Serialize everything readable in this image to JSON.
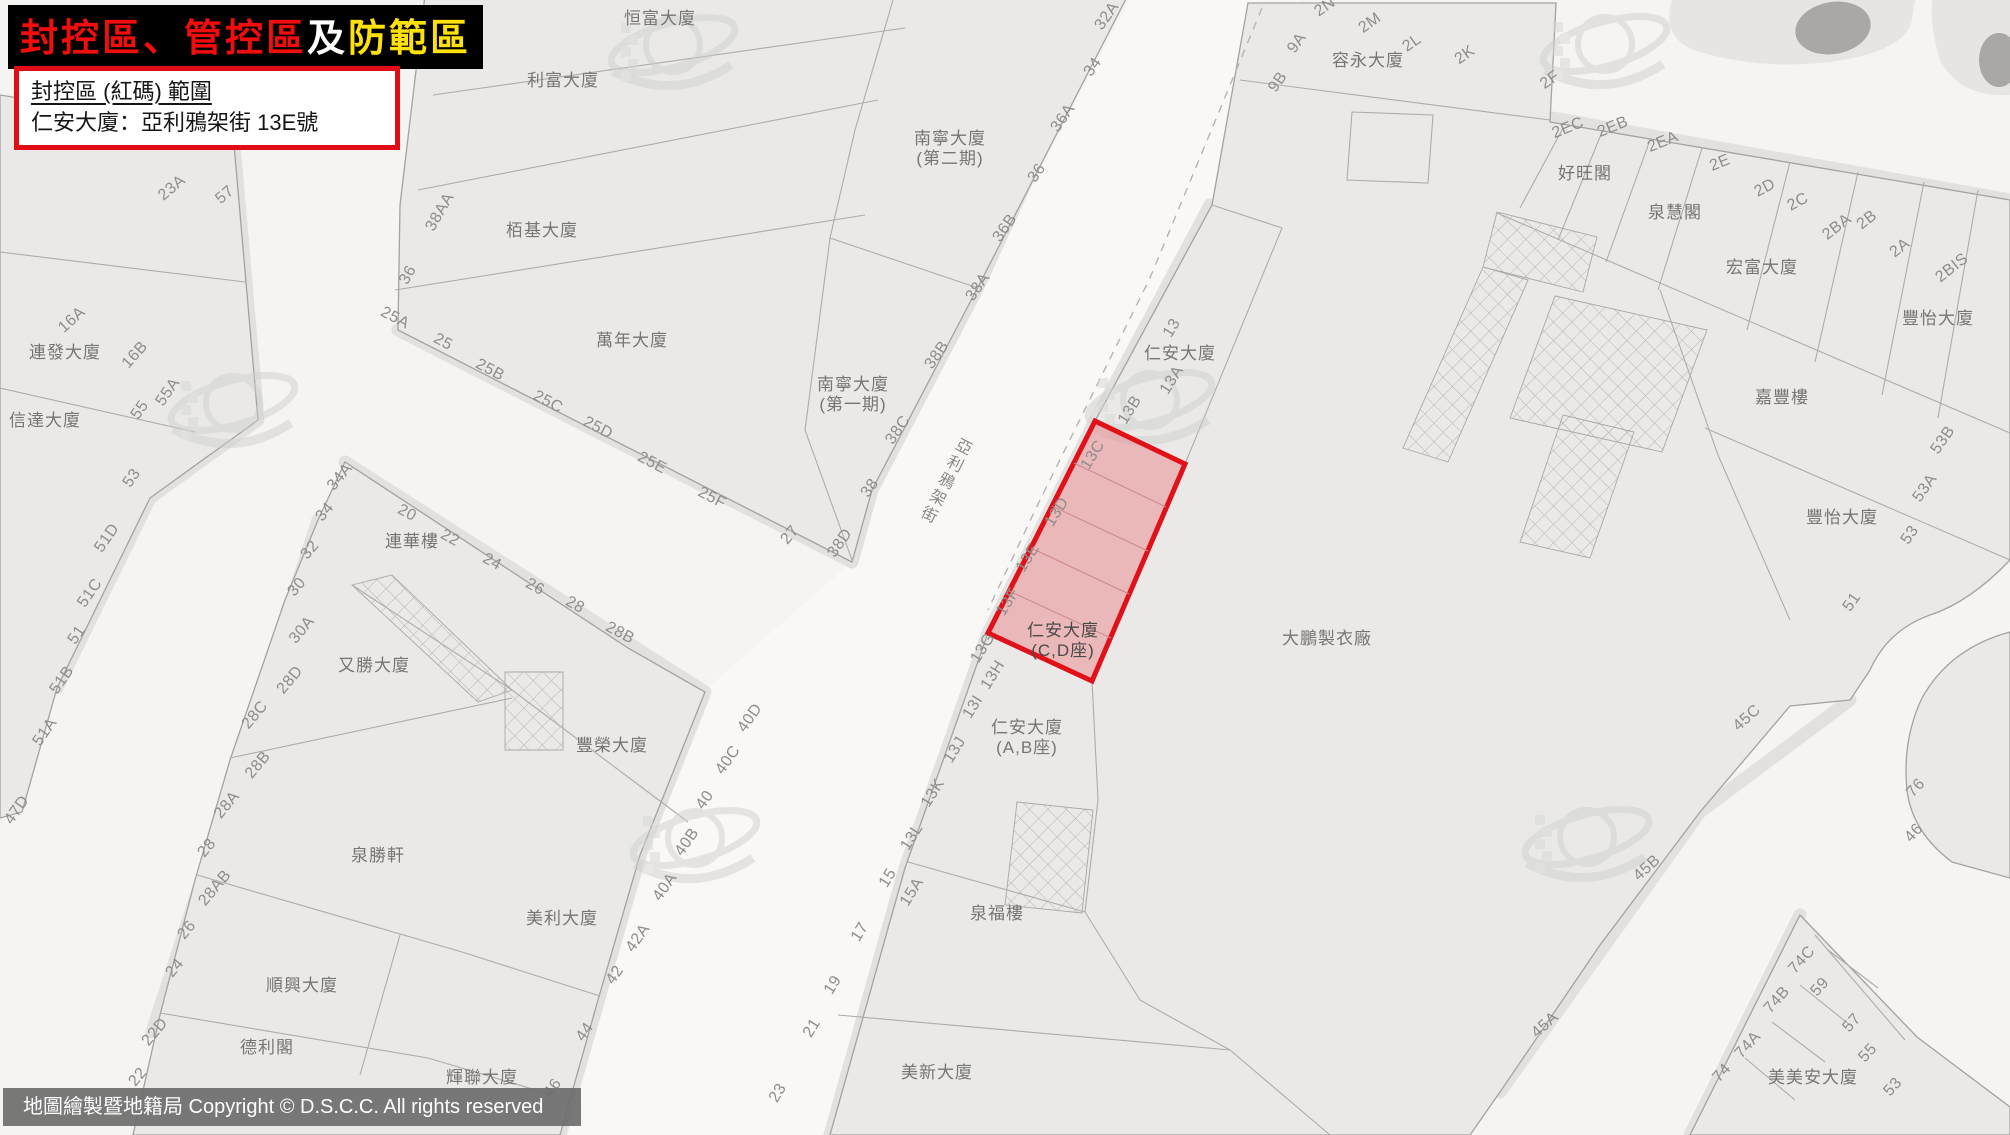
{
  "banner": {
    "segments": [
      {
        "text": "封控區、管控區",
        "color": "#f20d0d"
      },
      {
        "text": "及",
        "color": "#ffffff"
      },
      {
        "text": "防範區",
        "color": "#ffe10a"
      }
    ]
  },
  "info_box": {
    "line1": "封控區 (紅碼) 範圍",
    "line2": "仁安大廈：亞利鴉架街 13E號",
    "border_color": "#e20d14"
  },
  "footer": {
    "text": "地圖繪製暨地籍局 Copyright © D.S.C.C. All rights reserved"
  },
  "map": {
    "street_name": "亞利鴉架街",
    "red_zone": {
      "border_color": "#e1111a",
      "fill_color": "#ee7d82",
      "lots": [
        "13C",
        "13D",
        "13E",
        "13F",
        "13G"
      ],
      "building": "仁安大廈",
      "block": "(C,D座)"
    },
    "building_labels": [
      {
        "t": "恒富大廈",
        "x": 660,
        "y": 18
      },
      {
        "t": "利富大廈",
        "x": 563,
        "y": 80
      },
      {
        "t": "栢基大廈",
        "x": 542,
        "y": 230
      },
      {
        "t": "萬年大廈",
        "x": 632,
        "y": 340
      },
      {
        "ls": [
          "南寧大廈",
          "(第二期)"
        ],
        "x": 950,
        "y": 148
      },
      {
        "ls": [
          "南寧大廈",
          "(第一期)"
        ],
        "x": 853,
        "y": 394
      },
      {
        "t": "容永大廈",
        "x": 1368,
        "y": 60
      },
      {
        "t": "好旺閣",
        "x": 1585,
        "y": 173
      },
      {
        "t": "泉慧閣",
        "x": 1675,
        "y": 212
      },
      {
        "t": "宏富大廈",
        "x": 1762,
        "y": 267
      },
      {
        "t": "豐怡大廈",
        "x": 1938,
        "y": 318
      },
      {
        "t": "嘉豐樓",
        "x": 1782,
        "y": 397
      },
      {
        "t": "豐怡大廈",
        "x": 1842,
        "y": 517
      },
      {
        "t": "連發大廈",
        "x": 65,
        "y": 352
      },
      {
        "t": "信達大廈",
        "x": 45,
        "y": 420
      },
      {
        "t": "連華樓",
        "x": 412,
        "y": 541
      },
      {
        "t": "又勝大廈",
        "x": 374,
        "y": 665
      },
      {
        "t": "豐榮大廈",
        "x": 612,
        "y": 745
      },
      {
        "t": "泉勝軒",
        "x": 378,
        "y": 855
      },
      {
        "t": "美利大廈",
        "x": 562,
        "y": 918
      },
      {
        "t": "順興大廈",
        "x": 302,
        "y": 985
      },
      {
        "t": "德利閣",
        "x": 267,
        "y": 1047
      },
      {
        "t": "輝聯大廈",
        "x": 482,
        "y": 1077
      },
      {
        "t": "美新大廈",
        "x": 937,
        "y": 1072
      },
      {
        "t": "泉福樓",
        "x": 997,
        "y": 913
      },
      {
        "ls": [
          "仁安大廈",
          "(A,B座)"
        ],
        "x": 1027,
        "y": 737
      },
      {
        "t": "仁安大廈",
        "x": 1180,
        "y": 353
      },
      {
        "t": "大鵬製衣廠",
        "x": 1327,
        "y": 638
      },
      {
        "t": "美美安大廈",
        "x": 1813,
        "y": 1077
      },
      {
        "ls": [
          "仁安大廈",
          "(C,D座)"
        ],
        "x": 1063,
        "y": 640,
        "d": true
      }
    ],
    "lot_labels": [
      {
        "t": "23A",
        "x": 172,
        "y": 188,
        "r": -40
      },
      {
        "t": "57",
        "x": 225,
        "y": 195,
        "r": -40
      },
      {
        "t": "16A",
        "x": 72,
        "y": 320,
        "r": -42
      },
      {
        "t": "16B",
        "x": 135,
        "y": 355,
        "r": -48
      },
      {
        "t": "55A",
        "x": 168,
        "y": 392,
        "r": -55
      },
      {
        "t": "55",
        "x": 140,
        "y": 410,
        "r": -55
      },
      {
        "t": "53",
        "x": 132,
        "y": 478,
        "r": -55
      },
      {
        "t": "51D",
        "x": 107,
        "y": 538,
        "r": -55
      },
      {
        "t": "51C",
        "x": 90,
        "y": 593,
        "r": -55
      },
      {
        "t": "51",
        "x": 77,
        "y": 635,
        "r": -55
      },
      {
        "t": "51B",
        "x": 62,
        "y": 680,
        "r": -55
      },
      {
        "t": "51A",
        "x": 45,
        "y": 732,
        "r": -55
      },
      {
        "t": "47D",
        "x": 17,
        "y": 810,
        "r": -55
      },
      {
        "t": "38AA",
        "x": 440,
        "y": 212,
        "r": -60
      },
      {
        "t": "36",
        "x": 408,
        "y": 275,
        "r": -60
      },
      {
        "t": "25A",
        "x": 395,
        "y": 318,
        "r": 28
      },
      {
        "t": "25",
        "x": 443,
        "y": 342,
        "r": 28
      },
      {
        "t": "25B",
        "x": 490,
        "y": 370,
        "r": 28
      },
      {
        "t": "25C",
        "x": 548,
        "y": 402,
        "r": 28
      },
      {
        "t": "25D",
        "x": 598,
        "y": 428,
        "r": 28
      },
      {
        "t": "25E",
        "x": 652,
        "y": 463,
        "r": 28
      },
      {
        "t": "25F",
        "x": 712,
        "y": 498,
        "r": 28
      },
      {
        "t": "27",
        "x": 790,
        "y": 535,
        "r": -50
      },
      {
        "t": "38D",
        "x": 840,
        "y": 543,
        "r": -55
      },
      {
        "t": "38",
        "x": 870,
        "y": 488,
        "r": -55
      },
      {
        "t": "38C",
        "x": 898,
        "y": 430,
        "r": -55
      },
      {
        "t": "38B",
        "x": 937,
        "y": 355,
        "r": -55
      },
      {
        "t": "38A",
        "x": 978,
        "y": 287,
        "r": -55
      },
      {
        "t": "36B",
        "x": 1005,
        "y": 228,
        "r": -55
      },
      {
        "t": "36",
        "x": 1037,
        "y": 173,
        "r": -55
      },
      {
        "t": "36A",
        "x": 1063,
        "y": 118,
        "r": -55
      },
      {
        "t": "34",
        "x": 1093,
        "y": 67,
        "r": -55
      },
      {
        "t": "32A",
        "x": 1107,
        "y": 16,
        "r": -55
      },
      {
        "t": "2N",
        "x": 1325,
        "y": 7,
        "r": -35
      },
      {
        "t": "2M",
        "x": 1370,
        "y": 23,
        "r": -35
      },
      {
        "t": "2L",
        "x": 1412,
        "y": 43,
        "r": -35
      },
      {
        "t": "2K",
        "x": 1465,
        "y": 55,
        "r": -35
      },
      {
        "t": "9A",
        "x": 1297,
        "y": 43,
        "r": -55
      },
      {
        "t": "9B",
        "x": 1278,
        "y": 82,
        "r": -55
      },
      {
        "t": "2F",
        "x": 1550,
        "y": 80,
        "r": -35
      },
      {
        "t": "2EC",
        "x": 1568,
        "y": 128,
        "r": -22
      },
      {
        "t": "2EB",
        "x": 1613,
        "y": 127,
        "r": -22
      },
      {
        "t": "2EA",
        "x": 1663,
        "y": 142,
        "r": -22
      },
      {
        "t": "2E",
        "x": 1720,
        "y": 163,
        "r": -22
      },
      {
        "t": "2D",
        "x": 1765,
        "y": 188,
        "r": -28
      },
      {
        "t": "2C",
        "x": 1798,
        "y": 202,
        "r": -28
      },
      {
        "t": "2BA",
        "x": 1837,
        "y": 227,
        "r": -38
      },
      {
        "t": "2B",
        "x": 1867,
        "y": 220,
        "r": -38
      },
      {
        "t": "2A",
        "x": 1900,
        "y": 248,
        "r": -38
      },
      {
        "t": "2BIS",
        "x": 1952,
        "y": 268,
        "r": -38
      },
      {
        "t": "53B",
        "x": 1943,
        "y": 440,
        "r": -55
      },
      {
        "t": "53A",
        "x": 1925,
        "y": 488,
        "r": -55
      },
      {
        "t": "53",
        "x": 1910,
        "y": 535,
        "r": -55
      },
      {
        "t": "51",
        "x": 1852,
        "y": 602,
        "r": -55
      },
      {
        "t": "13",
        "x": 1172,
        "y": 328,
        "r": -58
      },
      {
        "t": "13A",
        "x": 1172,
        "y": 380,
        "r": -58
      },
      {
        "t": "13B",
        "x": 1130,
        "y": 410,
        "r": -58
      },
      {
        "t": "13C",
        "x": 1093,
        "y": 455,
        "r": -58
      },
      {
        "t": "13D",
        "x": 1057,
        "y": 512,
        "r": -58
      },
      {
        "t": "13E",
        "x": 1028,
        "y": 558,
        "r": -58
      },
      {
        "t": "13F",
        "x": 1008,
        "y": 602,
        "r": -58
      },
      {
        "t": "13G",
        "x": 983,
        "y": 648,
        "r": -58
      },
      {
        "t": "13H",
        "x": 993,
        "y": 675,
        "r": -58
      },
      {
        "t": "13I",
        "x": 973,
        "y": 707,
        "r": -58
      },
      {
        "t": "13J",
        "x": 955,
        "y": 750,
        "r": -58
      },
      {
        "t": "13K",
        "x": 933,
        "y": 793,
        "r": -58
      },
      {
        "t": "13L",
        "x": 912,
        "y": 837,
        "r": -58
      },
      {
        "t": "15",
        "x": 888,
        "y": 878,
        "r": -58
      },
      {
        "t": "15A",
        "x": 912,
        "y": 892,
        "r": -58
      },
      {
        "t": "17",
        "x": 860,
        "y": 932,
        "r": -58
      },
      {
        "t": "19",
        "x": 833,
        "y": 985,
        "r": -58
      },
      {
        "t": "21",
        "x": 812,
        "y": 1028,
        "r": -58
      },
      {
        "t": "23",
        "x": 778,
        "y": 1093,
        "r": -58
      },
      {
        "t": "40D",
        "x": 750,
        "y": 718,
        "r": -55
      },
      {
        "t": "40C",
        "x": 728,
        "y": 760,
        "r": -55
      },
      {
        "t": "40",
        "x": 705,
        "y": 800,
        "r": -55
      },
      {
        "t": "40B",
        "x": 687,
        "y": 842,
        "r": -55
      },
      {
        "t": "40A",
        "x": 665,
        "y": 887,
        "r": -55
      },
      {
        "t": "42A",
        "x": 638,
        "y": 938,
        "r": -55
      },
      {
        "t": "42",
        "x": 615,
        "y": 975,
        "r": -55
      },
      {
        "t": "44",
        "x": 585,
        "y": 1032,
        "r": -55
      },
      {
        "t": "46",
        "x": 553,
        "y": 1088,
        "r": -55
      },
      {
        "t": "34A",
        "x": 340,
        "y": 477,
        "r": -50
      },
      {
        "t": "34",
        "x": 325,
        "y": 512,
        "r": -50
      },
      {
        "t": "32",
        "x": 310,
        "y": 550,
        "r": -50
      },
      {
        "t": "30",
        "x": 297,
        "y": 587,
        "r": -50
      },
      {
        "t": "30A",
        "x": 302,
        "y": 630,
        "r": -50
      },
      {
        "t": "28D",
        "x": 290,
        "y": 680,
        "r": -50
      },
      {
        "t": "28C",
        "x": 255,
        "y": 715,
        "r": -50
      },
      {
        "t": "28B",
        "x": 258,
        "y": 765,
        "r": -50
      },
      {
        "t": "28A",
        "x": 227,
        "y": 805,
        "r": -50
      },
      {
        "t": "28",
        "x": 207,
        "y": 848,
        "r": -50
      },
      {
        "t": "28AB",
        "x": 215,
        "y": 888,
        "r": -50
      },
      {
        "t": "26",
        "x": 187,
        "y": 930,
        "r": -50
      },
      {
        "t": "24",
        "x": 175,
        "y": 968,
        "r": -50
      },
      {
        "t": "22D",
        "x": 155,
        "y": 1032,
        "r": -50
      },
      {
        "t": "22",
        "x": 138,
        "y": 1077,
        "r": -50
      },
      {
        "t": "20",
        "x": 407,
        "y": 513,
        "r": 28
      },
      {
        "t": "22",
        "x": 450,
        "y": 538,
        "r": 28
      },
      {
        "t": "24",
        "x": 492,
        "y": 562,
        "r": 28
      },
      {
        "t": "26",
        "x": 535,
        "y": 587,
        "r": 28
      },
      {
        "t": "28",
        "x": 575,
        "y": 605,
        "r": 28
      },
      {
        "t": "28B",
        "x": 620,
        "y": 633,
        "r": 28
      },
      {
        "t": "45C",
        "x": 1747,
        "y": 718,
        "r": -42
      },
      {
        "t": "45B",
        "x": 1647,
        "y": 868,
        "r": -42
      },
      {
        "t": "45A",
        "x": 1545,
        "y": 1025,
        "r": -42
      },
      {
        "t": "74C",
        "x": 1802,
        "y": 960,
        "r": -48
      },
      {
        "t": "74B",
        "x": 1777,
        "y": 1000,
        "r": -48
      },
      {
        "t": "74A",
        "x": 1748,
        "y": 1045,
        "r": -48
      },
      {
        "t": "74",
        "x": 1722,
        "y": 1073,
        "r": -48
      },
      {
        "t": "59",
        "x": 1820,
        "y": 987,
        "r": -48
      },
      {
        "t": "57",
        "x": 1852,
        "y": 1023,
        "r": -48
      },
      {
        "t": "55",
        "x": 1868,
        "y": 1053,
        "r": -48
      },
      {
        "t": "53",
        "x": 1893,
        "y": 1087,
        "r": -48
      },
      {
        "t": "76",
        "x": 1916,
        "y": 788,
        "r": -48
      },
      {
        "t": "46",
        "x": 1914,
        "y": 833,
        "r": -48
      }
    ]
  }
}
